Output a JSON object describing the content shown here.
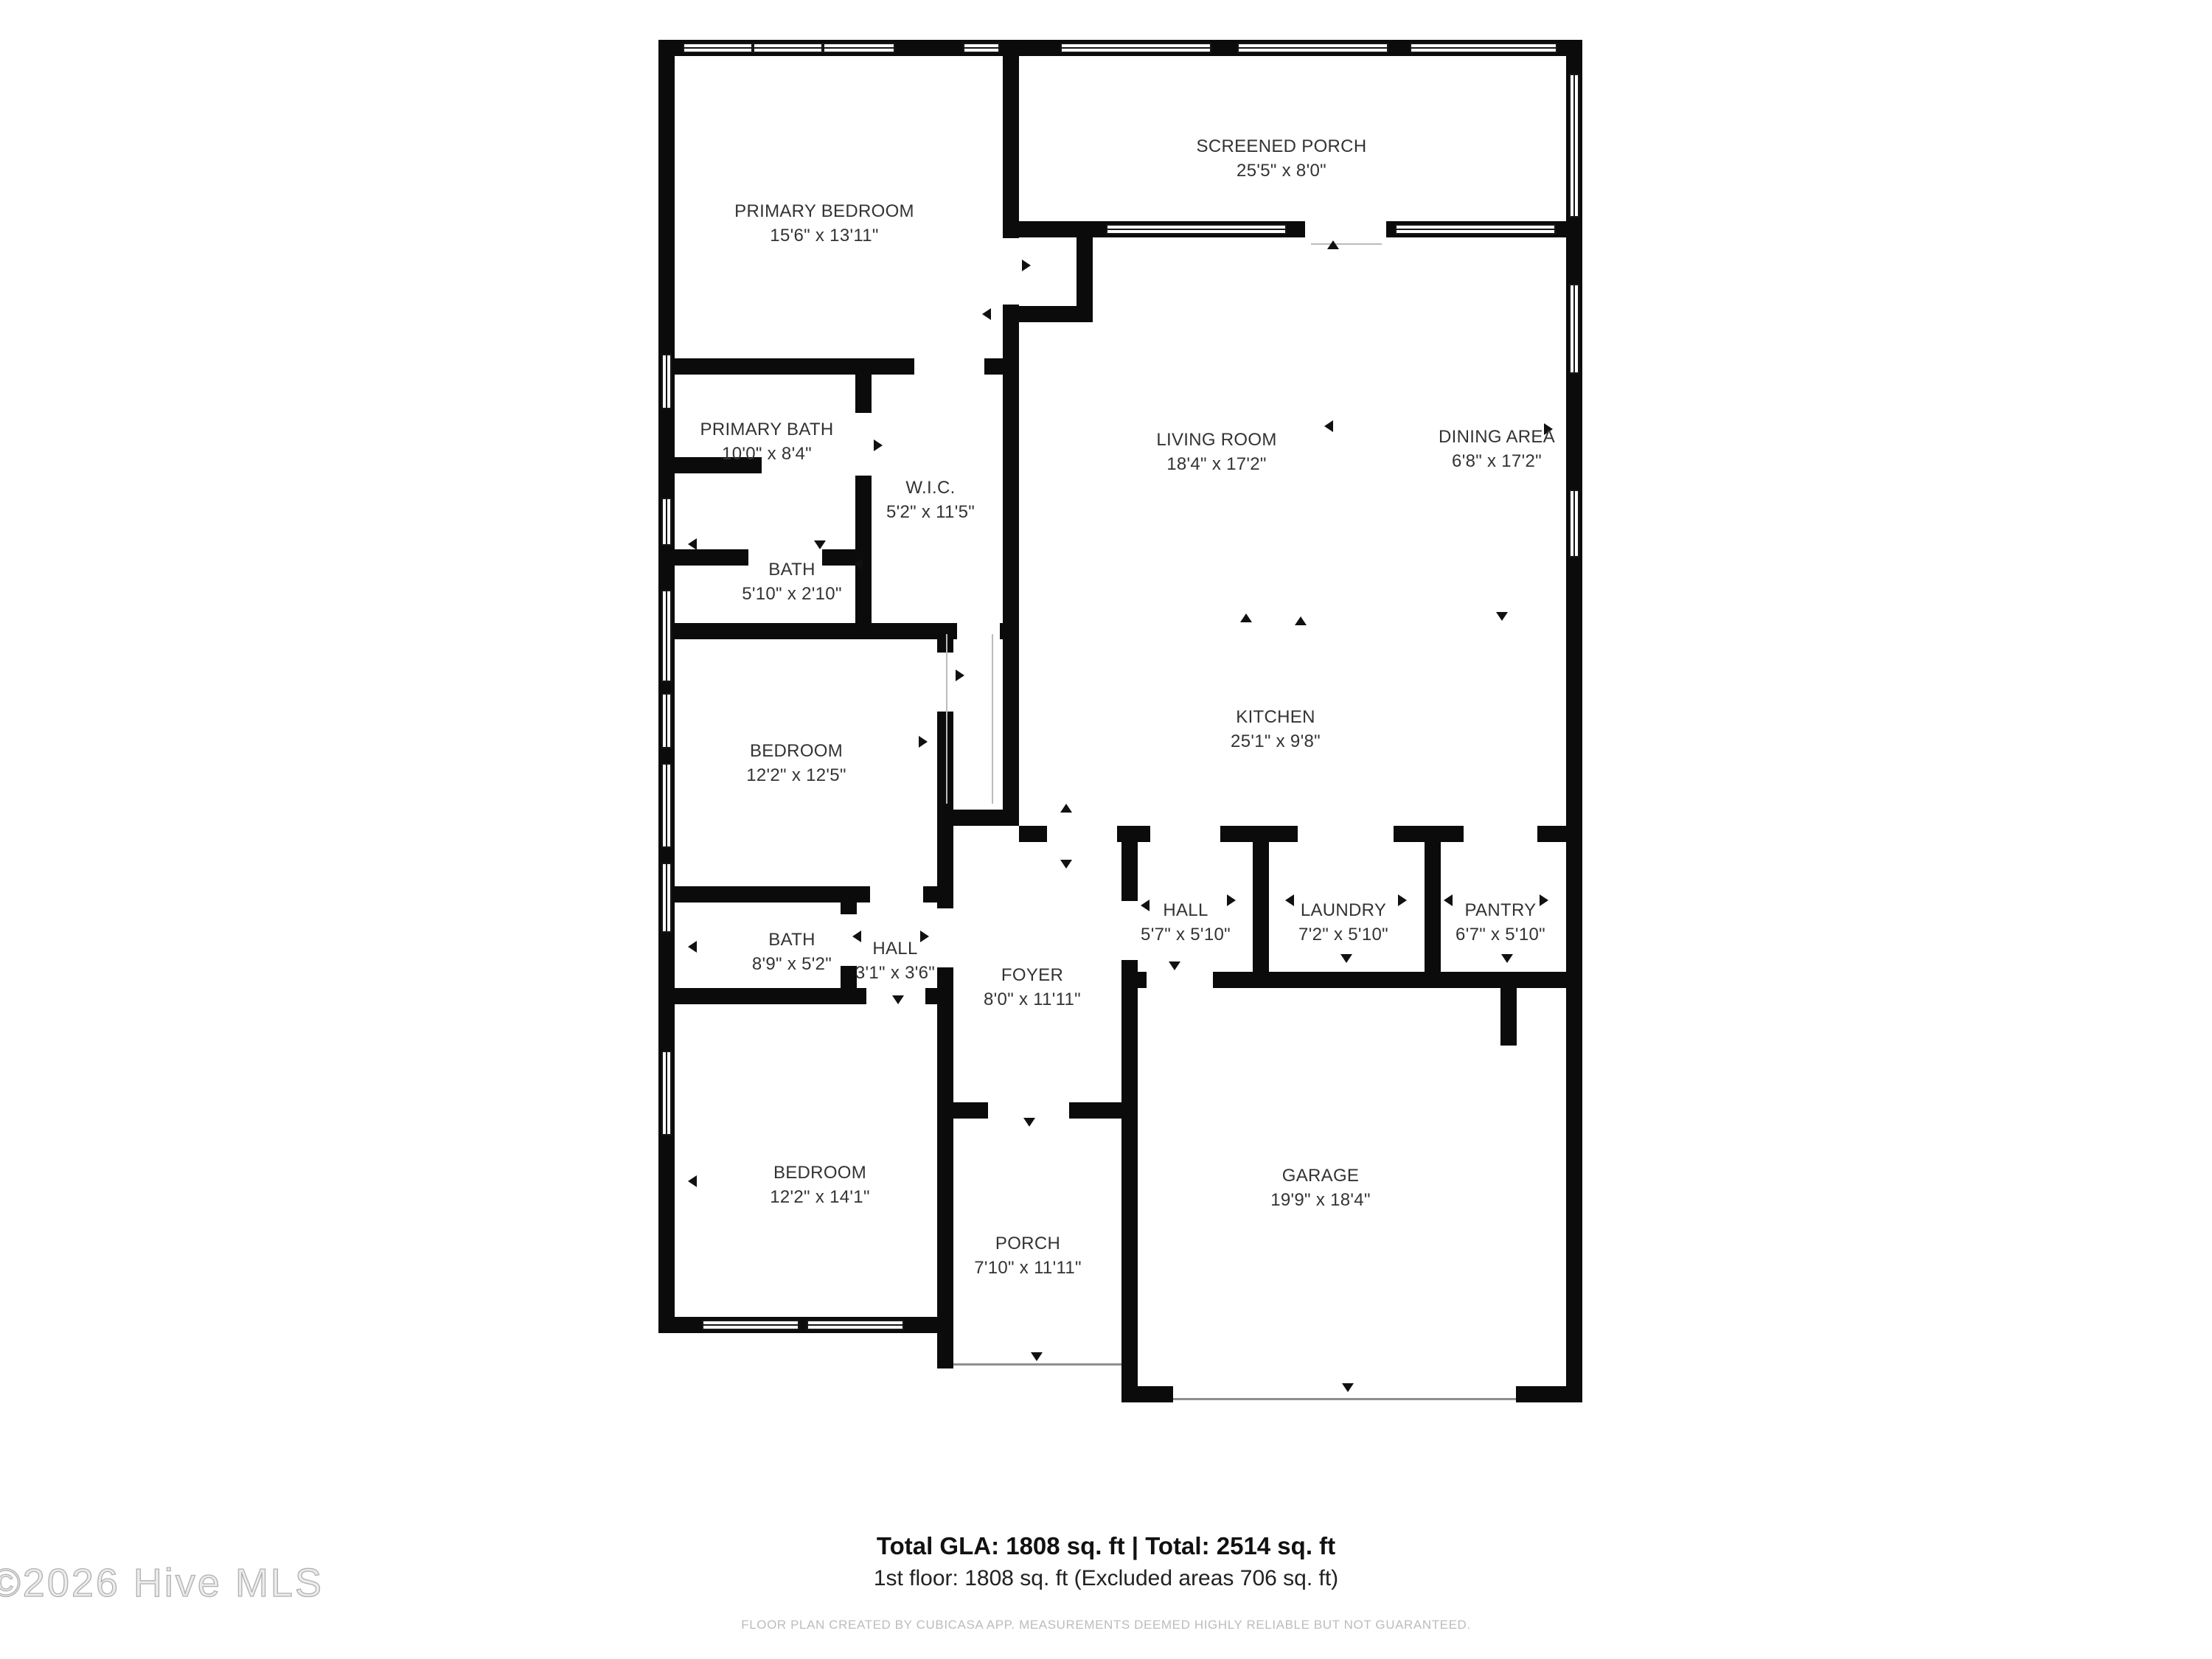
{
  "watermark": "©2026 Hive MLS",
  "summary": {
    "line1": "Total GLA: 1808 sq. ft | Total: 2514 sq. ft",
    "line2": "1st floor: 1808 sq. ft (Excluded areas 706 sq. ft)"
  },
  "footer": "FLOOR PLAN CREATED BY CUBICASA APP. MEASUREMENTS DEEMED HIGHLY RELIABLE BUT NOT GUARANTEED.",
  "colors": {
    "wall": "#0b0b0b",
    "room_text": "#333333",
    "watermark": "#c9c9c9",
    "footer_text": "#bcbcbc"
  },
  "rooms": [
    {
      "name": "PRIMARY BEDROOM",
      "dims": "15'6\" x 13'11\""
    },
    {
      "name": "SCREENED PORCH",
      "dims": "25'5\" x 8'0\""
    },
    {
      "name": "LIVING ROOM",
      "dims": "18'4\" x 17'2\""
    },
    {
      "name": "DINING AREA",
      "dims": "6'8\" x 17'2\""
    },
    {
      "name": "PRIMARY BATH",
      "dims": "10'0\" x 8'4\""
    },
    {
      "name": "W.I.C.",
      "dims": "5'2\" x 11'5\""
    },
    {
      "name": "BATH",
      "dims": "5'10\" x 2'10\""
    },
    {
      "name": "KITCHEN",
      "dims": "25'1\" x 9'8\""
    },
    {
      "name": "BEDROOM",
      "dims": "12'2\" x 12'5\""
    },
    {
      "name": "HALL",
      "dims": "5'7\" x 5'10\""
    },
    {
      "name": "LAUNDRY",
      "dims": "7'2\" x 5'10\""
    },
    {
      "name": "PANTRY",
      "dims": "6'7\" x 5'10\""
    },
    {
      "name": "BATH",
      "dims": "8'9\" x 5'2\""
    },
    {
      "name": "HALL",
      "dims": "3'1\" x 3'6\""
    },
    {
      "name": "FOYER",
      "dims": "8'0\" x 11'11\""
    },
    {
      "name": "BEDROOM",
      "dims": "12'2\" x 14'1\""
    },
    {
      "name": "PORCH",
      "dims": "7'10\" x 11'11\""
    },
    {
      "name": "GARAGE",
      "dims": "19'9\" x 18'4\""
    }
  ]
}
